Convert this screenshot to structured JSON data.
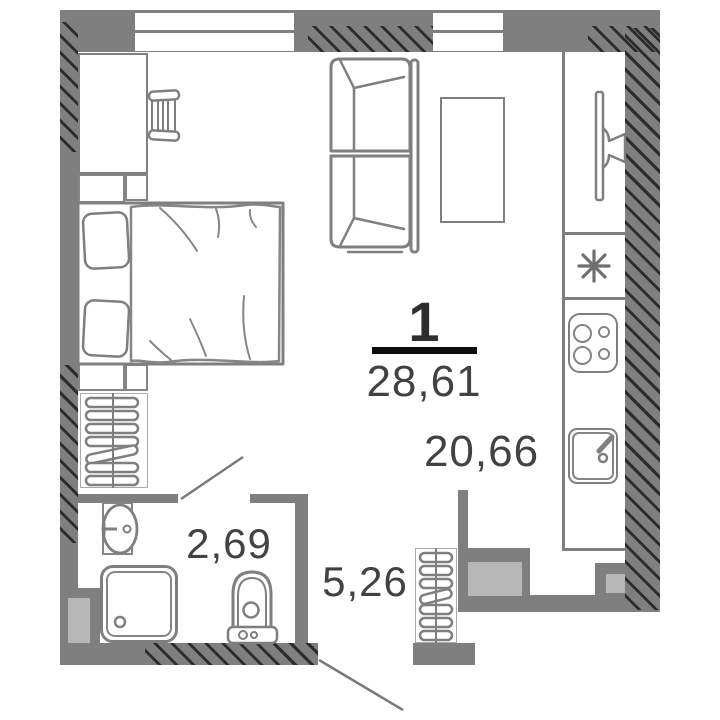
{
  "plan": {
    "apartment_number": "1",
    "total_area": "28,61",
    "rooms": [
      {
        "name": "living-room-kitchen",
        "area": "20,66"
      },
      {
        "name": "bathroom",
        "area": "2,69"
      },
      {
        "name": "hallway",
        "area": "5,26"
      }
    ],
    "symbols": {
      "fridge_asterisk": "eight-spoked-asterisk"
    },
    "colors": {
      "wall": "#7f7f7f",
      "hatch": "#2c2c2c",
      "shaft": "#b7b7b7",
      "outline": "#7f7f7f",
      "label_text": "#424242",
      "fraction_line": "#0d0d0d"
    }
  }
}
